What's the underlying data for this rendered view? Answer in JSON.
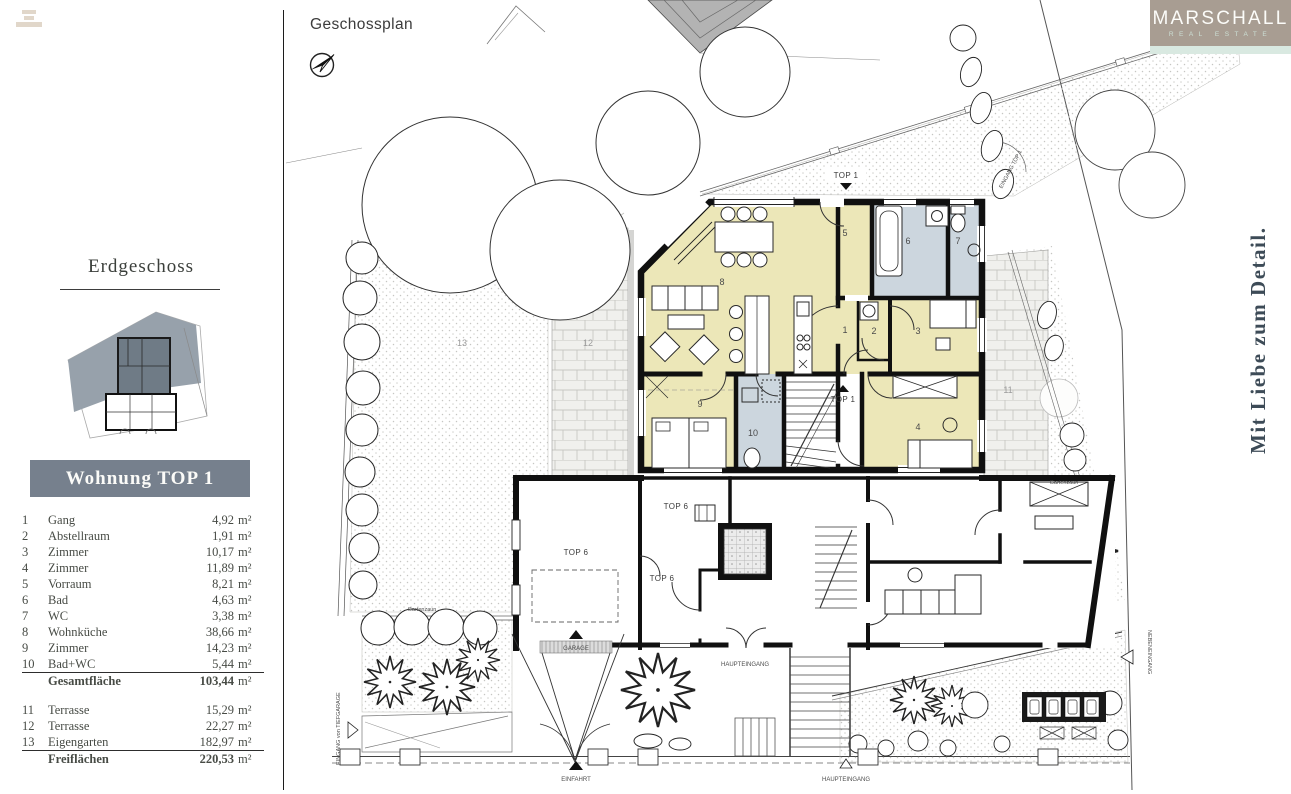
{
  "header": {
    "plan_title": "Geschossplan",
    "floor_title": "Erdgeschoss",
    "unit_banner": "Wohnung TOP 1"
  },
  "branding": {
    "logo_name": "MARSCHALL",
    "logo_subtitle": "REAL ESTATE",
    "tagline": "Mit Liebe zum Detail."
  },
  "sidebar": {
    "rooms": [
      {
        "num": "1",
        "name": "Gang",
        "area": "4,92",
        "unit": "m²"
      },
      {
        "num": "2",
        "name": "Abstellraum",
        "area": "1,91",
        "unit": "m²"
      },
      {
        "num": "3",
        "name": "Zimmer",
        "area": "10,17",
        "unit": "m²"
      },
      {
        "num": "4",
        "name": "Zimmer",
        "area": "11,89",
        "unit": "m²"
      },
      {
        "num": "5",
        "name": "Vorraum",
        "area": "8,21",
        "unit": "m²"
      },
      {
        "num": "6",
        "name": "Bad",
        "area": "4,63",
        "unit": "m²"
      },
      {
        "num": "7",
        "name": "WC",
        "area": "3,38",
        "unit": "m²"
      },
      {
        "num": "8",
        "name": "Wohnküche",
        "area": "38,66",
        "unit": "m²"
      },
      {
        "num": "9",
        "name": "Zimmer",
        "area": "14,23",
        "unit": "m²"
      },
      {
        "num": "10",
        "name": "Bad+WC",
        "area": "5,44",
        "unit": "m²"
      }
    ],
    "total": {
      "label": "Gesamtfläche",
      "area": "103,44",
      "unit": "m²"
    },
    "outdoor": [
      {
        "num": "11",
        "name": "Terrasse",
        "area": "15,29",
        "unit": "m²"
      },
      {
        "num": "12",
        "name": "Terrasse",
        "area": "22,27",
        "unit": "m²"
      },
      {
        "num": "13",
        "name": "Eigengarten",
        "area": "182,97",
        "unit": "m²"
      }
    ],
    "outdoor_total": {
      "label": "Freiflächen",
      "area": "220,53",
      "unit": "m²"
    }
  },
  "plan": {
    "labels": {
      "top1": "TOP 1",
      "top6": "TOP 6",
      "garage": "GARAGE",
      "einfahrt": "EINFAHRT",
      "haupteingang": "HAUPTEINGANG",
      "nebeneingang": "NEBENEINGANG",
      "eingang_tiefgarage": "EINGANG von TIEFGARAGE",
      "eingang_top1": "EINGANG TOP 1",
      "gartenzaun": "Gartenzaun",
      "area11": "11",
      "area12": "12",
      "area13": "13"
    },
    "colors": {
      "room_fill": "#ece7b8",
      "bath_fill": "#ccd6de",
      "wall": "#101010",
      "banner": "#76808d",
      "logo_bg": "#a89d92",
      "logo_strip": "#d9e9e1",
      "tagline": "#3d4b57",
      "roof_gray": "#b3b3b3"
    }
  }
}
